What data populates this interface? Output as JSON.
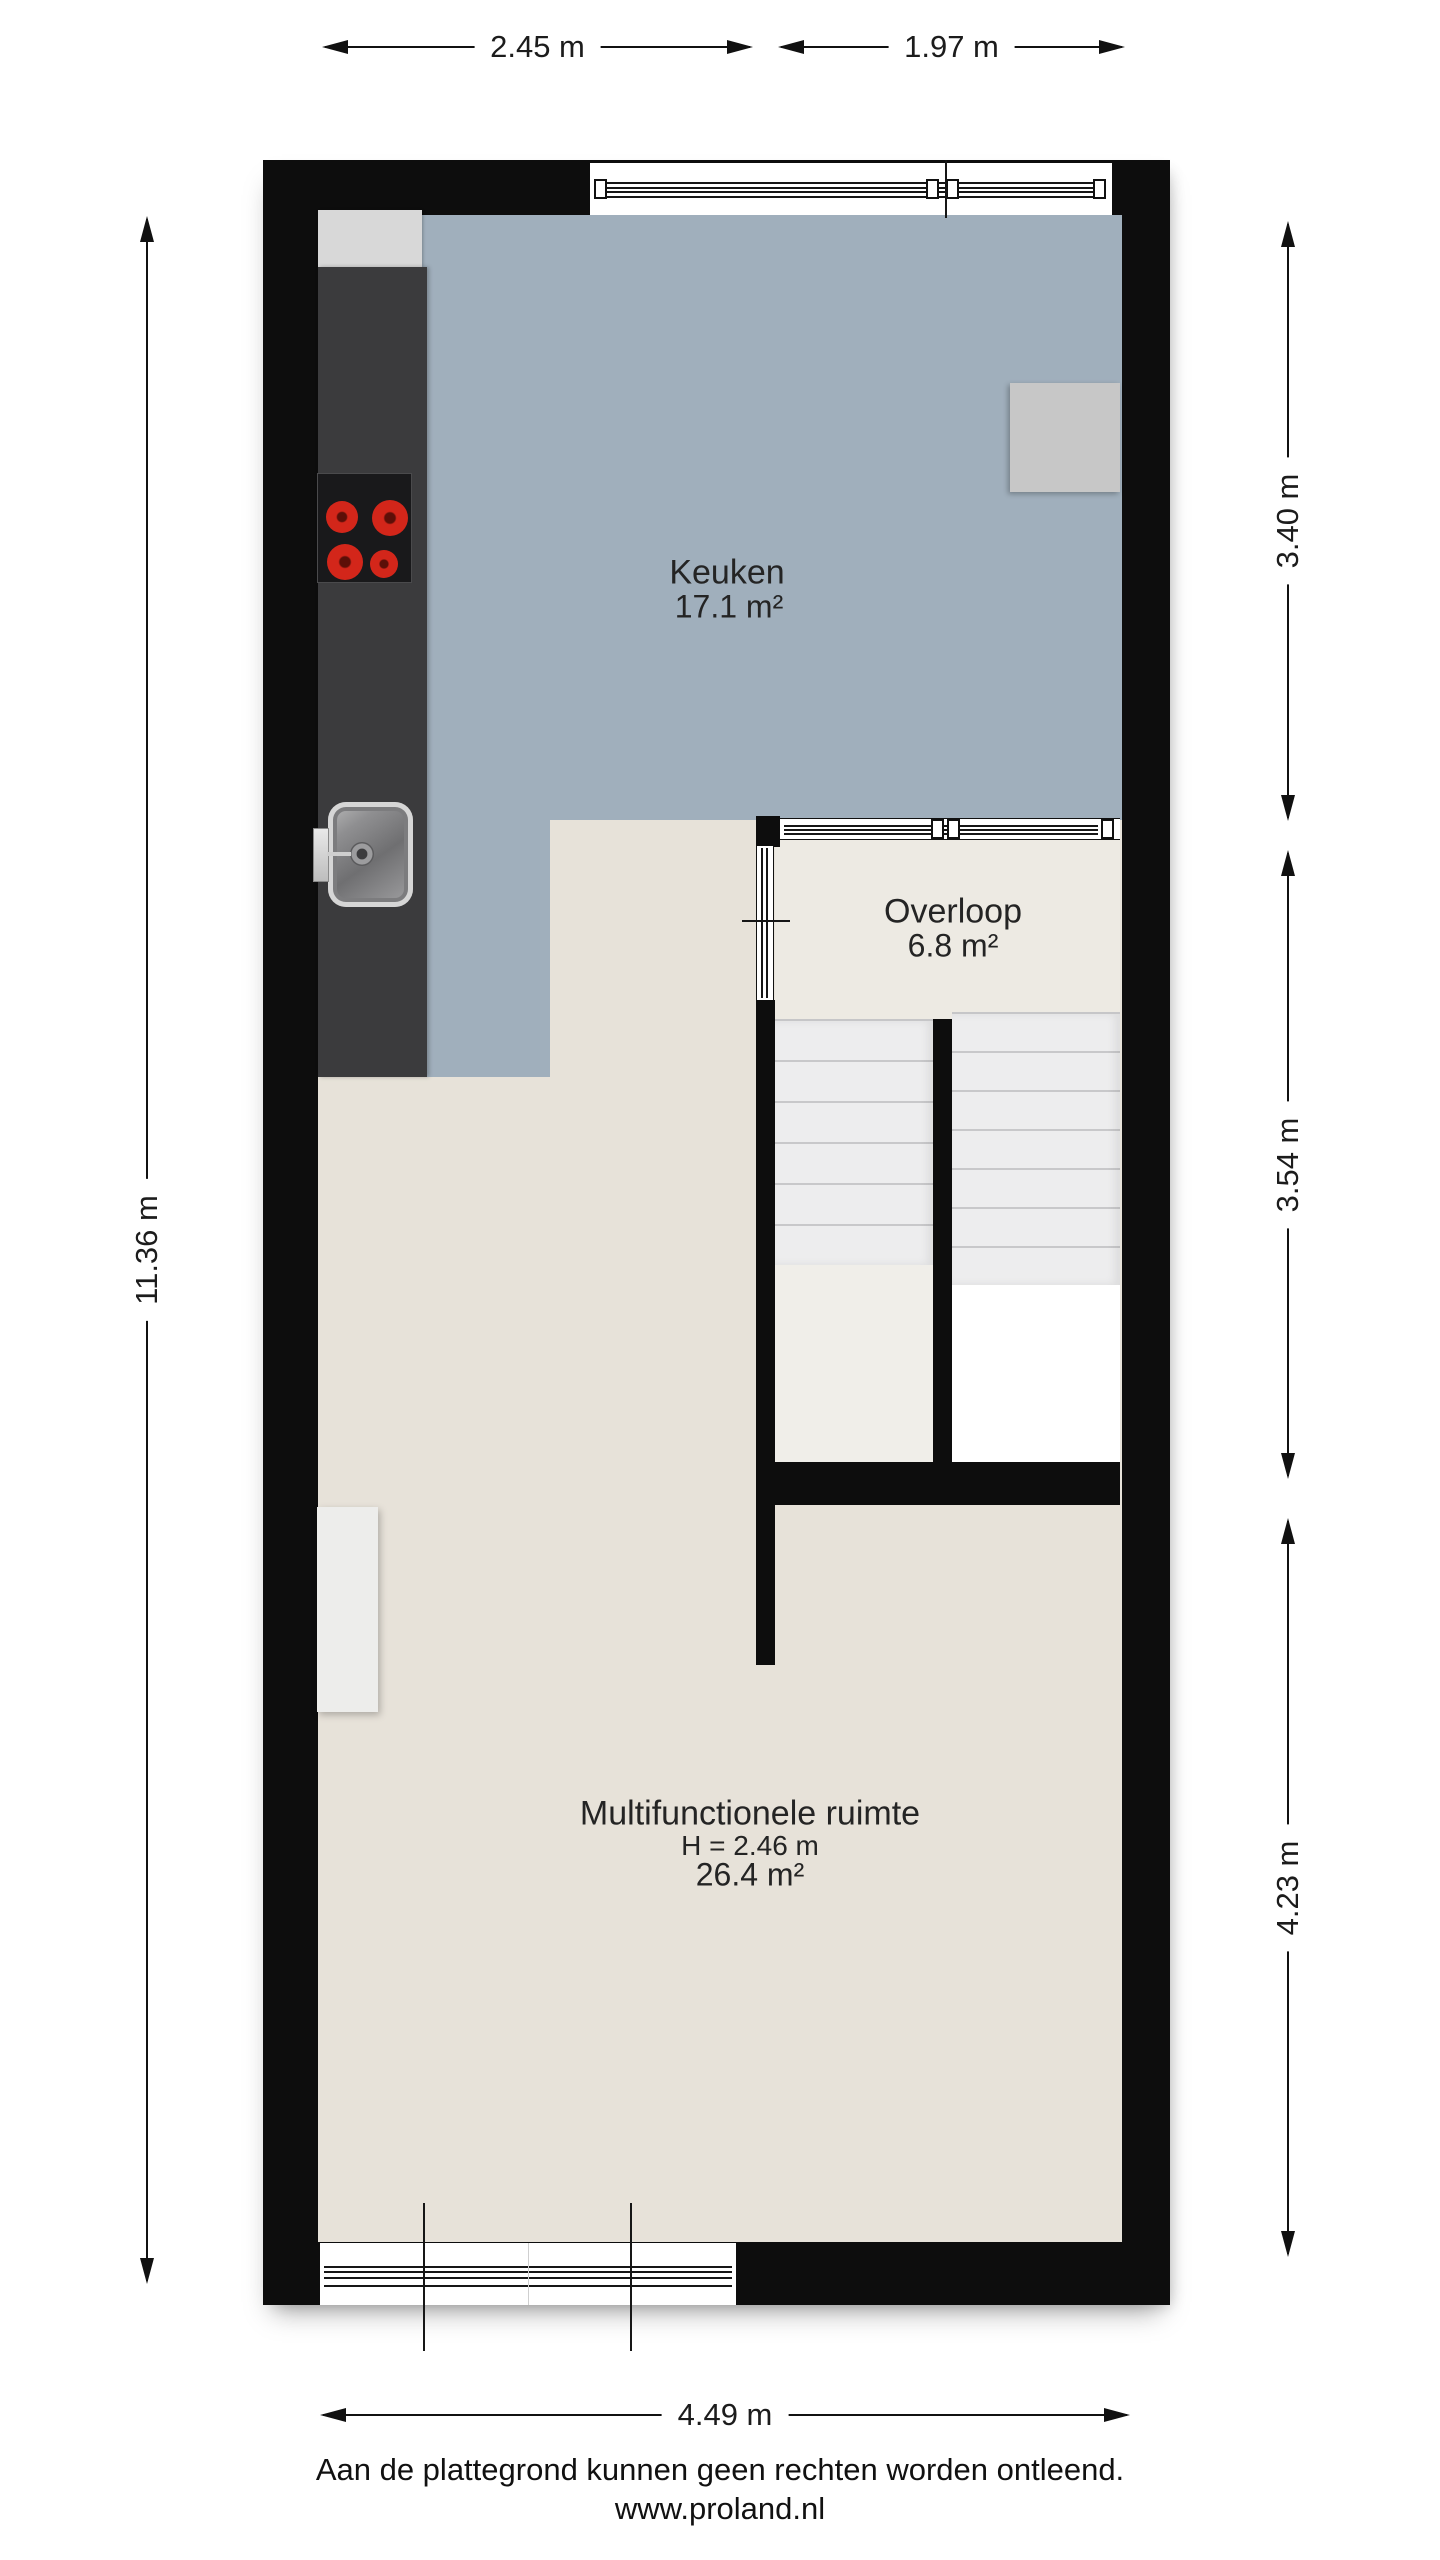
{
  "dimensions": {
    "top_left": "2.45 m",
    "top_right": "1.97 m",
    "left": "11.36 m",
    "right_top": "3.40 m",
    "right_middle": "3.54 m",
    "right_bottom": "4.23 m",
    "bottom": "4.49 m"
  },
  "rooms": {
    "keuken": {
      "name": "Keuken",
      "area": "17.1 m²"
    },
    "overloop": {
      "name": "Overloop",
      "area": "6.8 m²"
    },
    "multifunctionele_ruimte": {
      "name": "Multifunctionele ruimte",
      "height": "H = 2.46 m",
      "area": "26.4 m²"
    }
  },
  "footer": {
    "disclaimer": "Aan de plattegrond kunnen geen rechten worden ontleend.",
    "website": "www.proland.nl"
  },
  "colors": {
    "wall": "#0d0d0d",
    "kitchen_floor": "#a0afbc",
    "multifunctional_floor": "#e7e2d9",
    "overloop_floor": "#edeae3",
    "stair_landing": "#f0eee9",
    "counter": "#3b3b3d",
    "cooktop": "#19191b",
    "burner": "#d3261a",
    "appliance": "#c7c7c7",
    "cabinet": "#ededeb",
    "stair_tread": "#ededee"
  }
}
